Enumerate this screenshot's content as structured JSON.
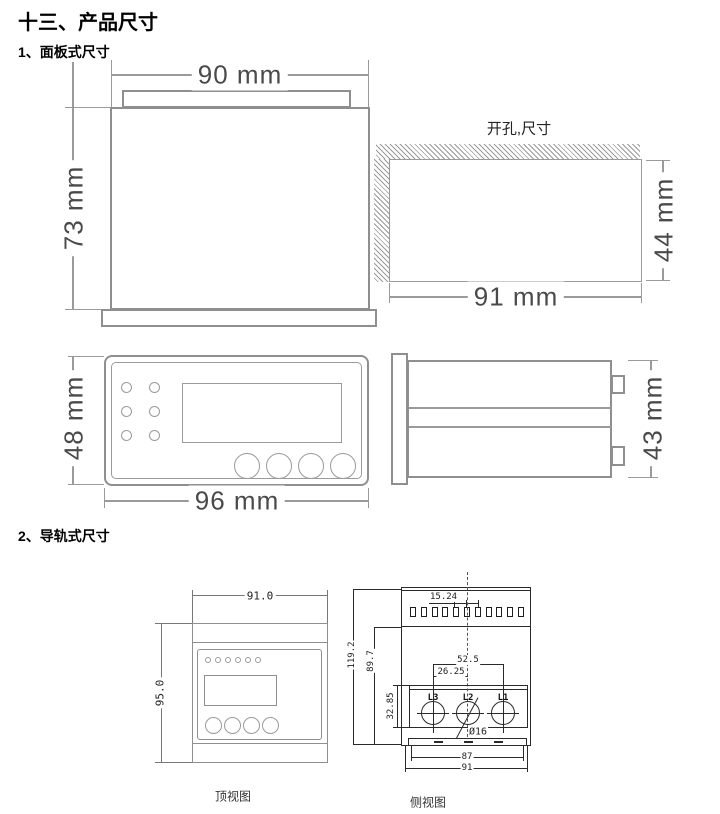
{
  "doc": {
    "title": "十三、产品尺寸",
    "section1_heading": "1、面板式尺寸",
    "section2_heading": "2、导轨式尺寸"
  },
  "panel": {
    "back_view": {
      "width": "90 mm",
      "height": "73 mm"
    },
    "cutout": {
      "label": "开孔,尺寸",
      "width": "91 mm",
      "height": "44 mm"
    },
    "front_view": {
      "width": "96 mm",
      "height": "48 mm"
    },
    "side_view": {
      "height": "43 mm"
    }
  },
  "rail": {
    "top_view": {
      "width": "91.0",
      "height": "95.0",
      "caption": "顶视图"
    },
    "side_view": {
      "caption": "侧视图",
      "overall_height": "119.2",
      "body_height": "89.7",
      "terminal_pitch": "15.24",
      "hole_spacing_total": "52.5",
      "hole_spacing_half": "26.25",
      "hole_box_height": "32.85",
      "hole_diameter": "Ø16",
      "rail_width": "87",
      "overall_width": "91",
      "phases": [
        "L3",
        "L2",
        "L1"
      ]
    }
  },
  "colors": {
    "panel_line": "#8f8f8f",
    "panel_text": "#4a4a4a",
    "cad_line": "#2a2a2a"
  }
}
